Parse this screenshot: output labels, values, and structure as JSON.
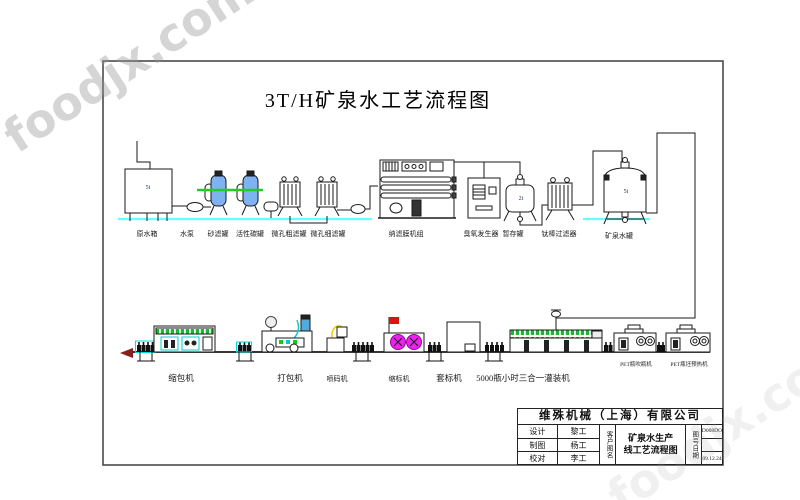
{
  "watermark": {
    "text": "foodjx.com",
    "registered_mark": "®"
  },
  "diagram": {
    "title": "3T/H矿泉水工艺流程图",
    "line1": {
      "equipment": [
        {
          "label": "原水箱",
          "capacity": "5t"
        },
        {
          "label": "水泵"
        },
        {
          "label": "砂滤罐"
        },
        {
          "label": "活性碳罐"
        },
        {
          "label": "微孔粗滤罐"
        },
        {
          "label": "微孔细滤罐"
        },
        {
          "label": "纳滤膜机组"
        },
        {
          "label": "臭氧发生器"
        },
        {
          "label": "暂存罐",
          "capacity": "2t"
        },
        {
          "label": "钛棒过滤器"
        },
        {
          "label": "矿泉水罐",
          "capacity": "5t"
        }
      ]
    },
    "line2": {
      "equipment": [
        {
          "label": "缩包机"
        },
        {
          "label": "打包机"
        },
        {
          "label": "喷码机"
        },
        {
          "label": "缩标机"
        },
        {
          "label": "套标机"
        },
        {
          "label": "5000瓶小时三合一灌装机"
        },
        {
          "label": "PET瓶吹瓶机"
        },
        {
          "label": "PET瓶坯预热机"
        }
      ]
    }
  },
  "title_block": {
    "company": "维殊机械（上海）有限公司",
    "rows": [
      {
        "role": "设计",
        "name": "黎工"
      },
      {
        "role": "制图",
        "name": "杨工"
      },
      {
        "role": "校对",
        "name": "李工"
      }
    ],
    "customer_label": "客户图名",
    "drawing_name_line1": "矿泉水生产",
    "drawing_name_line2": "线工艺流程图",
    "number_date_label": "图号日期",
    "drawing_number": "D008DO",
    "date": "09.12.24"
  },
  "colors": {
    "tank_blue": "#7fb2f0",
    "pipe_green": "#22cc22",
    "baseline_cyan": "#66ffff",
    "machine_cyan": "#00cccc",
    "label_magenta": "#ee22ee",
    "flag_red": "#e11111",
    "cable_yellow": "#ffcc00",
    "band_green": "#18b832",
    "outfeed_arrow": "#8b1f1f"
  }
}
